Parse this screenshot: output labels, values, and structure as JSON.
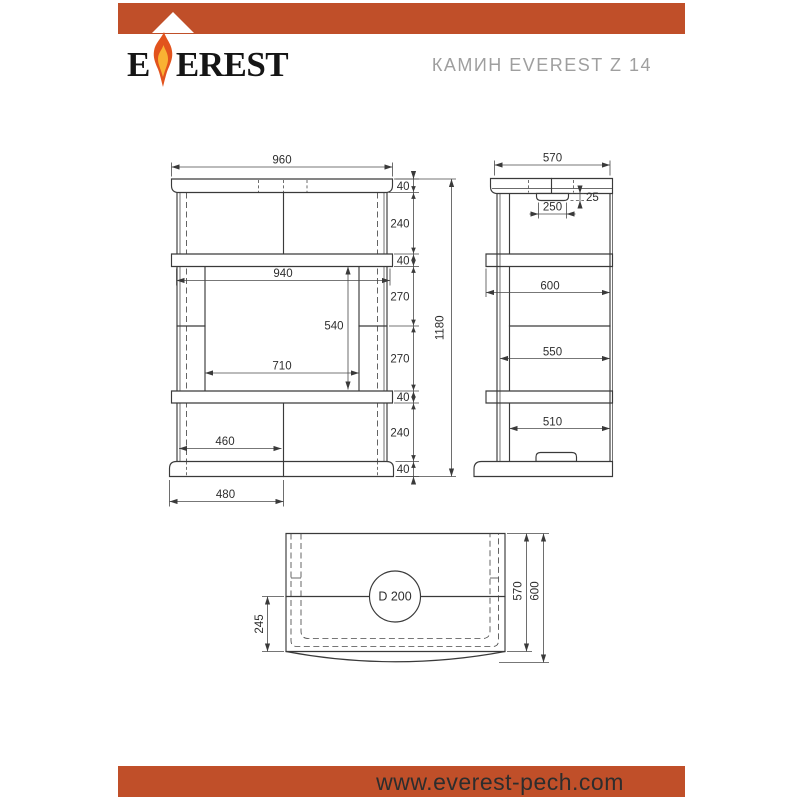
{
  "header": {
    "brand_prefix": "E",
    "brand_suffix": "EREST",
    "product_title": "КАМИН EVEREST Z 14"
  },
  "drawing": {
    "front_view": {
      "width_total": "960",
      "stack_heights": [
        "40",
        "240",
        "40",
        "270",
        "270",
        "40",
        "240",
        "40"
      ],
      "height_total": "1180",
      "shelf_inner_width": "940",
      "firebox_height": "540",
      "opening_width": "710",
      "inner_half_width": "460",
      "base_half_width": "480"
    },
    "side_view": {
      "depth_total": "570",
      "vent_height": "25",
      "vent_width": "250",
      "shelf_depth": "600",
      "body_depth": "550",
      "base_inner_depth": "510"
    },
    "top_view": {
      "flue_diameter": "D 200",
      "flue_center_offset": "245",
      "body_depth": "570",
      "overall_depth": "600"
    }
  },
  "footer": {
    "website": "www.everest-pech.com"
  },
  "colors": {
    "accent_orange": "#c04f29",
    "flame_outer": "#e2531d",
    "flame_inner": "#f9b233",
    "line_dark": "#3a3a3a",
    "title_gray": "#9f9f9f"
  }
}
